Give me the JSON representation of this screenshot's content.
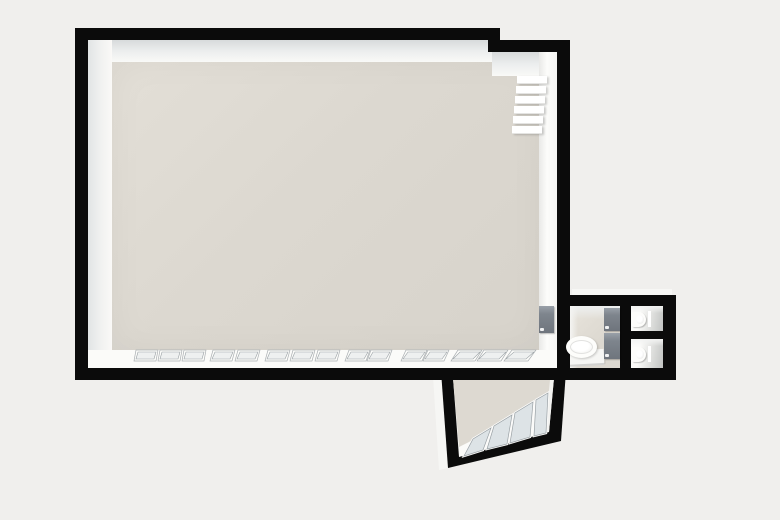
{
  "meta": {
    "app": "floor-plan-3d-viewer",
    "view": "top-down 3d render",
    "visible_text": []
  },
  "colors": {
    "bg": "#f0efed",
    "wall": "#0b0b0b",
    "floor": "#dcd8d0",
    "face-light": "#fafaf8",
    "glass": "#dde3e6",
    "glass-light": "#eef0f0",
    "door": "#7e858d",
    "door-light": "#99a0a8",
    "fixture-white": "#fdfdfb"
  },
  "plan": {
    "rooms": [
      {
        "id": "main-room",
        "shape": "large rectangle with stepped top-right corner",
        "features": [
          "staircase",
          "window-wall-bottom",
          "door-to-bathroom"
        ]
      },
      {
        "id": "bathroom",
        "fixtures": [
          "sink",
          "counter",
          "cabinet-door-upper",
          "cabinet-door-lower"
        ]
      },
      {
        "id": "wc-top",
        "fixtures": [
          "toilet"
        ]
      },
      {
        "id": "wc-bottom",
        "fixtures": [
          "toilet"
        ]
      },
      {
        "id": "balcony",
        "shape": "rotated quadrilateral",
        "features": [
          "glazed-window-band"
        ]
      }
    ],
    "stairs": {
      "steps": 6
    },
    "windows": {
      "bottom_row": {
        "y": 7,
        "h": 9,
        "panes": [
          {
            "x": 35,
            "w": 20,
            "s": 2
          },
          {
            "x": 59,
            "w": 20,
            "s": 2
          },
          {
            "x": 83,
            "w": 20,
            "s": 2
          },
          {
            "x": 111,
            "w": 20,
            "s": 3
          },
          {
            "x": 136,
            "w": 20,
            "s": 3
          },
          {
            "x": 166,
            "w": 20,
            "s": 3
          },
          {
            "x": 191,
            "w": 20,
            "s": 3
          },
          {
            "x": 216,
            "w": 20,
            "s": 3
          },
          {
            "x": 246,
            "w": 19,
            "s": 4
          },
          {
            "x": 268,
            "w": 19,
            "s": 4
          },
          {
            "x": 302,
            "w": 19,
            "s": 5
          },
          {
            "x": 324,
            "w": 19,
            "s": 5
          },
          {
            "x": 352,
            "w": 22,
            "s": 7
          },
          {
            "x": 378,
            "w": 22,
            "s": 7
          },
          {
            "x": 405,
            "w": 22,
            "s": 8
          }
        ]
      },
      "balcony_band_panes": 4
    }
  }
}
